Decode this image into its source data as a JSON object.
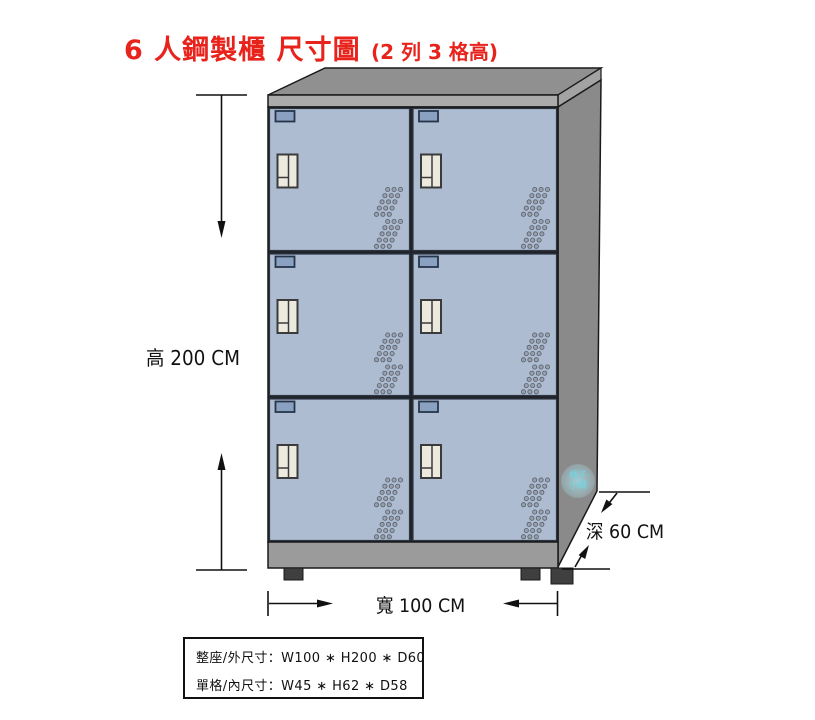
{
  "title": {
    "main": "6 人鋼製櫃 尺寸圖",
    "suffix": "(2 列 3 格高)"
  },
  "dimensions": {
    "height_label": "高 200 CM",
    "width_label": "寬 100 CM",
    "depth_label": "深 60 CM"
  },
  "spec_box": {
    "outer_line": "整座/外尺寸：W100 ∗ H200 ∗ D60",
    "inner_line": "單格/內尺寸：W45 ∗ H62 ∗ D58"
  },
  "cabinet": {
    "rows": 3,
    "columns": 2,
    "door_count": 6
  },
  "watermark": {
    "text": "櫃子小舖"
  },
  "colors": {
    "title_red": "#e8231c",
    "door_face": "#adbcd1",
    "name_plate": "#8ba1c1",
    "handle": "#eceade",
    "cabinet_top": "#909090",
    "cabinet_side": "#8a8a8a",
    "front_strip": "#ababab",
    "base_strip": "#9b9b9b",
    "foot": "#3f3f3f",
    "outline": "#1a1a1a"
  }
}
